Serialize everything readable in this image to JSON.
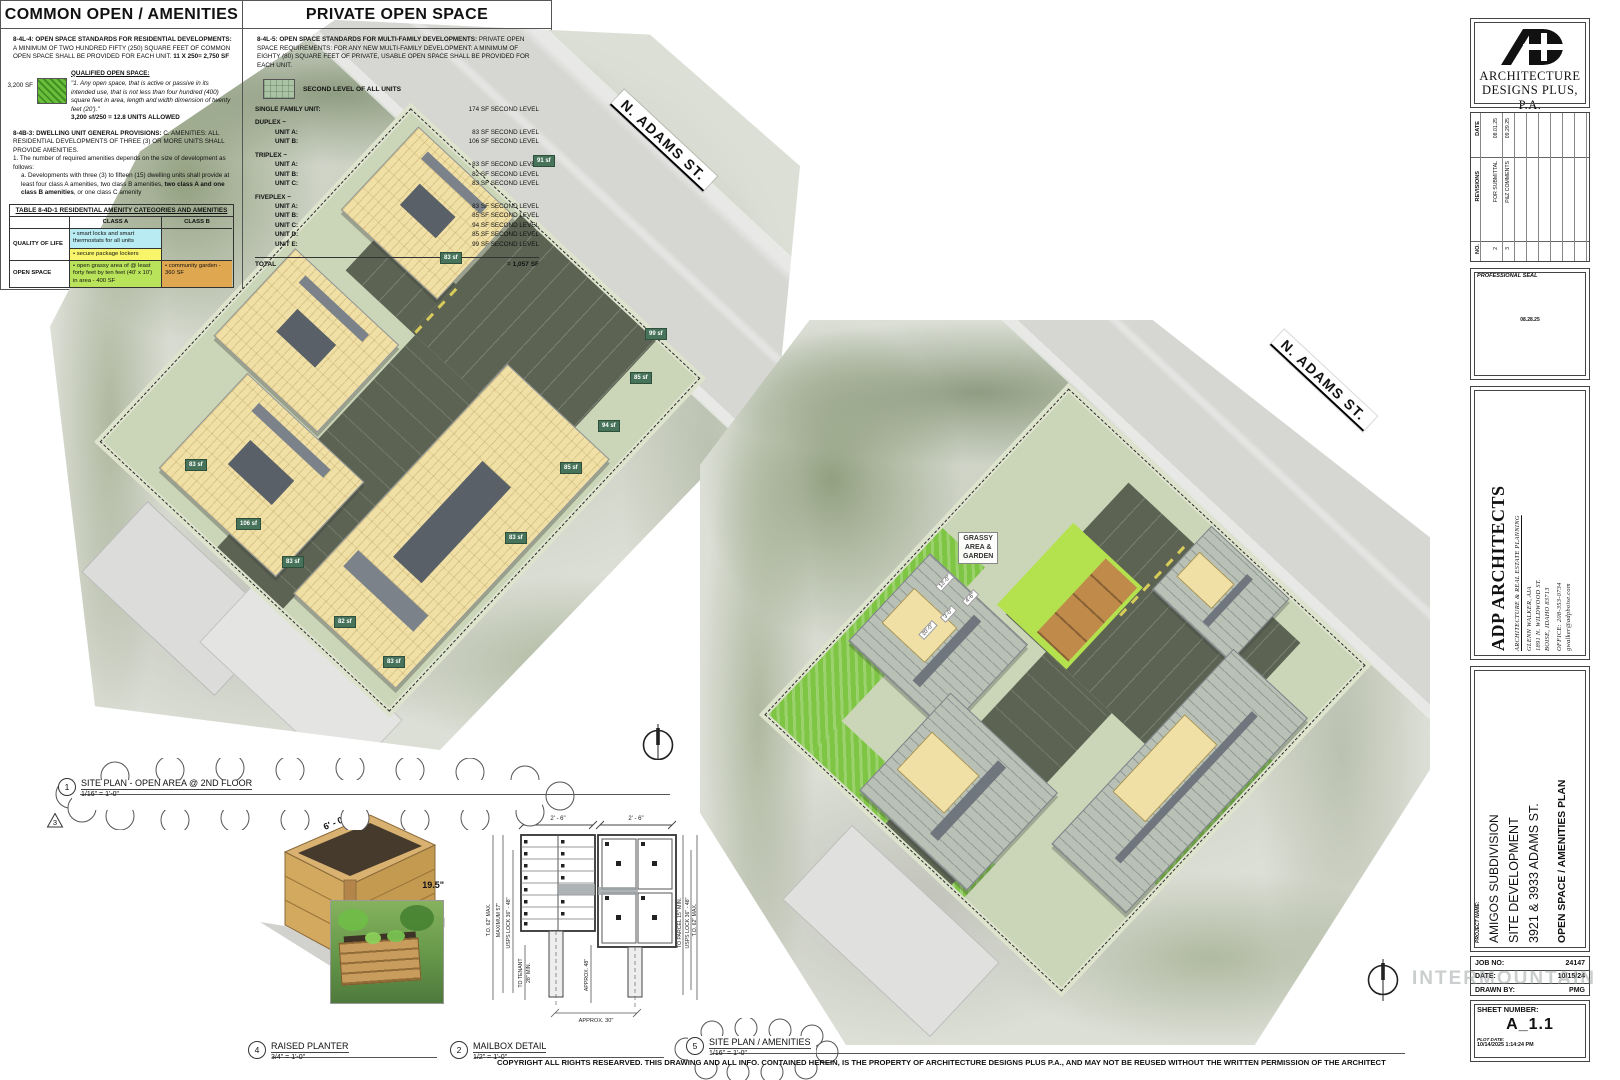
{
  "street": {
    "name": "N. ADAMS ST."
  },
  "plans": {
    "plan1": {
      "callout_no": "1",
      "callout_title": "SITE PLAN - OPEN AREA @ 2ND FLOOR",
      "callout_scale": "1/16\" = 1'-0\"",
      "revision_triangle": "3",
      "sf_labels": [
        "91 sf",
        "83 sf",
        "83 sf",
        "106 sf",
        "83 sf",
        "82 sf",
        "83 sf",
        "99 sf",
        "85 sf",
        "94 sf",
        "85 sf",
        "83 sf"
      ]
    },
    "plan2": {
      "callout_no": "5",
      "callout_title": "SITE PLAN / AMENITIES",
      "callout_scale": "1/16\" = 1'-0\"",
      "grassy_label_1": "GRASSY",
      "grassy_label_2": "AREA &",
      "grassy_label_3": "GARDEN",
      "dims": [
        "13'-0\"",
        "4'-6\"",
        "3'-0\"",
        "20'-0\""
      ]
    }
  },
  "common_panel": {
    "title": "COMMON OPEN / AMENITIES",
    "s1_bold": "8-4L-4: OPEN SPACE STANDARDS FOR RESIDENTIAL DEVELOPMENTS:",
    "s1_text": " A MINIMUM OF TWO HUNDRED FIFTY (250) SQUARE FEET OF COMMON OPEN SPACE SHALL BE PROVIDED FOR EACH UNIT.",
    "s1_calc": "11 X 250= 2,750 SF",
    "qualified_heading": "QUALIFIED OPEN SPACE:",
    "swatch_sf": "3,200 SF",
    "quote": "\"1.  Any open space, that is active or passive in its intended use, that is not less than four hundred (400) square feet in area, length and width dimension of twenty feet (20').\"",
    "quote_calc": "3,200 sf/250 = 12.8 UNITS ALLOWED",
    "s2_bold": "8-4B-3: DWELLING UNIT GENERAL PROVISIONS:",
    "s2_text": " C.  AMENITIES: ALL RESIDENTIAL DEVELOPMENTS OF THREE (3) OR MORE UNITS SHALL PROVIDE AMENITIES.",
    "s2_item1": "1. The number of required amenities depends on the size of development as follows:",
    "s2_item1a_pre": "a. Developments with three (3) to fifteen (15) dwelling units shall provide at least four class A amenities, two class B amenities, ",
    "s2_item1a_bold": "two class A and one class B amenities",
    "s2_item1a_post": ", or one class C amenity",
    "table": {
      "title": "TABLE 8-4D-1 RESIDENTIAL AMENITY CATEGORIES AND AMENITIES",
      "class_a": "CLASS A",
      "class_b": "CLASS B",
      "row1_label": "QUALITY OF LIFE",
      "row1_a1": "• smart locks and smart thermostats for all units",
      "row1_a2": "• secure package lockers",
      "row2_label": "OPEN SPACE",
      "row2_a": "• open grassy area of @ least forty feet by ten feet (40' x 10') in area - 400 SF",
      "row2_b": "• community garden - 360 SF"
    }
  },
  "private_panel": {
    "title": "PRIVATE OPEN SPACE",
    "s1_bold": "8-4L-5: OPEN SPACE STANDARDS FOR MULTI-FAMILY DEVELOPMENTS:",
    "s1_text": " PRIVATE OPEN SPACE REQUIREMENTS: FOR ANY NEW MULTI-FAMILY DEVELOPMENT: A MINIMUM OF EIGHTY (80) SQUARE FEET OF PRIVATE, USABLE OPEN SPACE SHALL BE PROVIDED FOR EACH UNIT.",
    "legend": "SECOND LEVEL OF ALL UNITS",
    "rows": [
      {
        "label": "SINGLE FAMILY UNIT:",
        "value": "174 SF SECOND LEVEL"
      },
      {
        "label": "DUPLEX ~",
        "value": ""
      },
      {
        "label": "UNIT A:",
        "value": "83 SF SECOND LEVEL"
      },
      {
        "label": "UNIT B:",
        "value": "106 SF SECOND LEVEL"
      },
      {
        "label": "TRIPLEX ~",
        "value": ""
      },
      {
        "label": "UNIT A:",
        "value": "83 SF SECOND LEVEL"
      },
      {
        "label": "UNIT B:",
        "value": "82  SF SECOND LEVEL"
      },
      {
        "label": "UNIT C:",
        "value": "83 SF SECOND LEVEL"
      },
      {
        "label": "FIVEPLEX ~",
        "value": ""
      },
      {
        "label": "UNIT A:",
        "value": "83 SF SECOND LEVEL"
      },
      {
        "label": "UNIT B:",
        "value": "85 SF SECOND LEVEL"
      },
      {
        "label": "UNIT C:",
        "value": "94 SF SECOND LEVEL"
      },
      {
        "label": "UNIT D:",
        "value": "85 SF SECOND LEVEL"
      },
      {
        "label": "UNIT E:",
        "value": "99 SF SECOND LEVEL"
      }
    ],
    "total_label": "TOTAL",
    "total_value": "= 1,057 SF"
  },
  "titleblock": {
    "logo_line1": "ARCHITECTURE",
    "logo_line2": "DESIGNS PLUS, P.A.",
    "rev_no_h": "NO.",
    "rev_rev_h": "REVISIONS",
    "rev_date_h": "DATE",
    "rev1_no": "2",
    "rev1_desc": "FOR SUBMITTAL",
    "rev1_date": "08.01.25",
    "rev2_no": "3",
    "rev2_desc": "P&Z COMMENTS",
    "rev2_date": "09.29.25",
    "seal_label": "PROFESSIONAL SEAL",
    "seal_note": "08.28.25",
    "firm_name": "ADP ARCHITECTS",
    "firm_tag": "ARCHITECTURE & REAL ESTATE PLANNING",
    "firm_contact1": "GLENN WALKER, AIA",
    "firm_contact2": "1891 N. WILDWOOD ST.",
    "firm_contact3": "BOISE, IDAHO 83713",
    "firm_phone": "OFFICE: 208-353-0734",
    "firm_email": "gwalker@adpboise.com",
    "project_label": "PROJECT NAME:",
    "project_line1": "AMIGOS SUBDIVISION",
    "project_line2": "SITE DEVELOPMENT",
    "project_line3": "3921  & 3933 ADAMS ST.",
    "sheet_title": "OPEN SPACE / AMENITIES PLAN",
    "job_no_label": "JOB NO:",
    "job_no": "24147",
    "date_label": "DATE:",
    "date": "10/15/24",
    "drawn_label": "DRAWN BY:",
    "drawn": "PMG",
    "sheet_no_label": "SHEET NUMBER:",
    "sheet_no": "A_1.1",
    "plot_label": "PLOT DATE:",
    "plot_date": "10/14/2025 1:14:24 PM"
  },
  "details": {
    "planter": {
      "callout_no": "4",
      "title": "RAISED PLANTER",
      "scale": "3/4\" = 1'-0\"",
      "dim_length": "6' - 0\"",
      "dim_width": "3' - 0\"",
      "dim_height": "19.5\""
    },
    "mailbox": {
      "callout_no": "2",
      "title": "MAILBOX DETAIL",
      "scale": "1/2\" = 1'-0\"",
      "dim_top_left": "2' - 6\"",
      "dim_top_right": "2' - 6\"",
      "l1": "T.O. 62\" MAX.",
      "l2": "MAXIMUM 57\"",
      "l3": "USPS LOCK 36\" - 48\"",
      "l4": "TO TENANT",
      "l5": "28\" MIN.",
      "mid": "APPROX. 48\"",
      "bottom": "APPROX. 30\"",
      "r1": "TO PARCEL 15\" MIN.",
      "r2": "USPS LOCK 36\" - 48\"",
      "r3": "T.O. 62\" MAX."
    }
  },
  "sheet": {
    "copyright": "COPYRIGHT ALL RIGHTS RESEARVED.  THIS DRAWING AND ALL INFO. CONTAINED HEREIN, IS THE PROPERTY OF ARCHITECTURE DESIGNS PLUS P.A., AND MAY NOT BE REUSED WITHOUT THE WRITTEN PERMISSION OF THE ARCHITECT",
    "watermark": "INTERMOUNTAIN"
  }
}
